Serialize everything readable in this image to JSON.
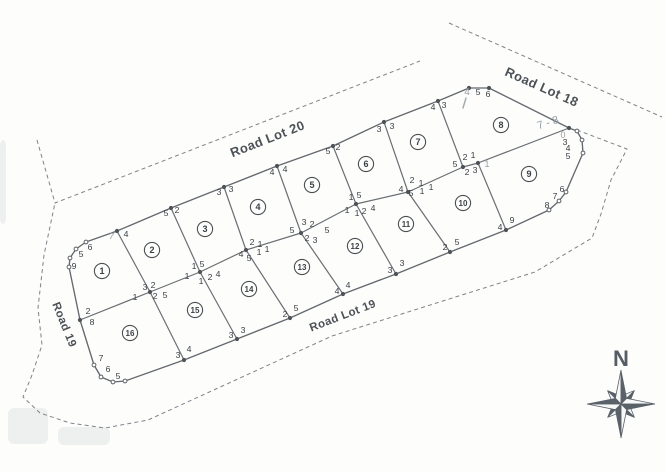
{
  "map": {
    "ink_color": "#64696e",
    "pencil_color": "#9aa0a8",
    "roads": [
      {
        "id": "road-lot-20",
        "label": "Road Lot 20",
        "x": 269,
        "y": 143,
        "rot": -21.5,
        "size": 13
      },
      {
        "id": "road-lot-18",
        "label": "Road Lot 18",
        "x": 540,
        "y": 91,
        "rot": 24,
        "size": 13
      },
      {
        "id": "road-lot-19",
        "label": "Road Lot 19",
        "x": 344,
        "y": 319,
        "rot": -21,
        "size": 11.5
      },
      {
        "id": "road-19",
        "label": "Road 19",
        "x": 61,
        "y": 326,
        "rot": 68,
        "size": 11.5
      }
    ],
    "compass": {
      "label": "N",
      "cx": 621,
      "cy": 404,
      "letter_x": 621,
      "letter_y": 366,
      "r_cardinal": 34,
      "r_diagonal": 19,
      "r_base": 8
    },
    "lots": [
      {
        "n": "1",
        "x": 102,
        "y": 271
      },
      {
        "n": "2",
        "x": 152,
        "y": 250
      },
      {
        "n": "3",
        "x": 205,
        "y": 229
      },
      {
        "n": "4",
        "x": 258,
        "y": 207
      },
      {
        "n": "5",
        "x": 312,
        "y": 185
      },
      {
        "n": "6",
        "x": 366,
        "y": 164
      },
      {
        "n": "7",
        "x": 418,
        "y": 142
      },
      {
        "n": "8",
        "x": 501,
        "y": 125
      },
      {
        "n": "9",
        "x": 529,
        "y": 174
      },
      {
        "n": "10",
        "x": 463,
        "y": 203
      },
      {
        "n": "11",
        "x": 406,
        "y": 224
      },
      {
        "n": "12",
        "x": 355,
        "y": 246
      },
      {
        "n": "13",
        "x": 302,
        "y": 267
      },
      {
        "n": "14",
        "x": 249,
        "y": 289
      },
      {
        "n": "15",
        "x": 195,
        "y": 310
      },
      {
        "n": "16",
        "x": 130,
        "y": 333
      }
    ],
    "outline": [
      [
        86,
        242
      ],
      [
        117,
        231
      ],
      [
        171,
        208
      ],
      [
        224,
        187
      ],
      [
        277,
        166
      ],
      [
        333,
        146
      ],
      [
        384,
        122
      ],
      [
        438,
        101
      ],
      [
        469,
        88
      ],
      [
        489,
        88
      ],
      [
        569,
        128
      ],
      [
        577,
        131
      ],
      [
        582,
        140
      ],
      [
        583,
        153
      ],
      [
        566,
        192
      ],
      [
        559,
        201
      ],
      [
        549,
        210
      ],
      [
        506,
        230
      ],
      [
        450,
        252
      ],
      [
        396,
        274
      ],
      [
        343,
        294
      ],
      [
        290,
        318
      ],
      [
        237,
        339
      ],
      [
        184,
        360
      ],
      [
        125,
        381
      ],
      [
        113,
        382
      ],
      [
        101,
        377
      ],
      [
        94,
        365
      ],
      [
        80,
        320
      ],
      [
        69,
        267
      ],
      [
        70,
        258
      ],
      [
        76,
        249
      ],
      [
        86,
        242
      ]
    ],
    "inner_lines": [
      [
        [
          80,
          320
        ],
        [
          150,
          292
        ],
        [
          200,
          272
        ],
        [
          246,
          250
        ],
        [
          301,
          233
        ],
        [
          356,
          204
        ],
        [
          408,
          192
        ],
        [
          463,
          167
        ],
        [
          478,
          163
        ],
        [
          569,
          128
        ]
      ],
      [
        [
          117,
          231
        ],
        [
          150,
          292
        ],
        [
          184,
          360
        ]
      ],
      [
        [
          171,
          208
        ],
        [
          200,
          272
        ],
        [
          237,
          339
        ]
      ],
      [
        [
          224,
          187
        ],
        [
          246,
          250
        ],
        [
          290,
          318
        ]
      ],
      [
        [
          277,
          166
        ],
        [
          301,
          233
        ],
        [
          343,
          294
        ]
      ],
      [
        [
          333,
          146
        ],
        [
          356,
          204
        ],
        [
          396,
          274
        ]
      ],
      [
        [
          384,
          122
        ],
        [
          408,
          192
        ],
        [
          450,
          252
        ]
      ],
      [
        [
          438,
          101
        ],
        [
          463,
          167
        ]
      ],
      [
        [
          478,
          163
        ],
        [
          506,
          230
        ]
      ]
    ],
    "dashed_lines": [
      [
        [
          37,
          140
        ],
        [
          55,
          203
        ],
        [
          420,
          61
        ]
      ],
      [
        [
          449,
          23
        ],
        [
          560,
          72
        ],
        [
          662,
          117
        ]
      ],
      [
        [
          577,
          130
        ],
        [
          627,
          149
        ],
        [
          611,
          180
        ],
        [
          601,
          214
        ],
        [
          592,
          238
        ],
        [
          535,
          272
        ],
        [
          465,
          294
        ],
        [
          332,
          336
        ],
        [
          148,
          420
        ],
        [
          105,
          428
        ],
        [
          70,
          423
        ],
        [
          40,
          413
        ],
        [
          23,
          397
        ],
        [
          32,
          375
        ],
        [
          42,
          345
        ],
        [
          38,
          308
        ],
        [
          44,
          255
        ],
        [
          55,
          203
        ]
      ]
    ],
    "junction_dots": [
      [
        117,
        231
      ],
      [
        171,
        208
      ],
      [
        224,
        187
      ],
      [
        277,
        166
      ],
      [
        333,
        146
      ],
      [
        384,
        122
      ],
      [
        438,
        101
      ],
      [
        469,
        88
      ],
      [
        489,
        88
      ],
      [
        569,
        128
      ],
      [
        80,
        320
      ],
      [
        150,
        292
      ],
      [
        200,
        272
      ],
      [
        246,
        250
      ],
      [
        301,
        233
      ],
      [
        356,
        204
      ],
      [
        408,
        192
      ],
      [
        463,
        167
      ],
      [
        478,
        163
      ],
      [
        184,
        360
      ],
      [
        237,
        339
      ],
      [
        290,
        318
      ],
      [
        343,
        294
      ],
      [
        396,
        274
      ],
      [
        450,
        252
      ],
      [
        506,
        230
      ]
    ],
    "open_dots": [
      [
        86,
        242
      ],
      [
        76,
        249
      ],
      [
        70,
        258
      ],
      [
        69,
        267
      ],
      [
        94,
        365
      ],
      [
        101,
        377
      ],
      [
        113,
        382
      ],
      [
        125,
        381
      ],
      [
        577,
        131
      ],
      [
        582,
        140
      ],
      [
        583,
        153
      ],
      [
        566,
        192
      ],
      [
        559,
        201
      ],
      [
        549,
        210
      ]
    ],
    "vertex_labels": [
      {
        "t": "4",
        "x": 126,
        "y": 237
      },
      {
        "t": "5",
        "x": 166,
        "y": 216
      },
      {
        "t": "2",
        "x": 177,
        "y": 213
      },
      {
        "t": "3",
        "x": 219,
        "y": 195
      },
      {
        "t": "3",
        "x": 231,
        "y": 192
      },
      {
        "t": "4",
        "x": 272,
        "y": 175
      },
      {
        "t": "4",
        "x": 285,
        "y": 172
      },
      {
        "t": "5",
        "x": 328,
        "y": 154
      },
      {
        "t": "2",
        "x": 338,
        "y": 150
      },
      {
        "t": "3",
        "x": 379,
        "y": 132
      },
      {
        "t": "3",
        "x": 392,
        "y": 129
      },
      {
        "t": "4",
        "x": 433,
        "y": 110
      },
      {
        "t": "3",
        "x": 444,
        "y": 108
      },
      {
        "t": "5",
        "x": 478,
        "y": 95
      },
      {
        "t": "6",
        "x": 488,
        "y": 97
      },
      {
        "t": "6",
        "x": 90,
        "y": 250
      },
      {
        "t": "5",
        "x": 81,
        "y": 257
      },
      {
        "t": "9",
        "x": 74,
        "y": 269
      },
      {
        "t": "2",
        "x": 88,
        "y": 314
      },
      {
        "t": "8",
        "x": 92,
        "y": 325
      },
      {
        "t": "7",
        "x": 101,
        "y": 361
      },
      {
        "t": "6",
        "x": 108,
        "y": 372
      },
      {
        "t": "5",
        "x": 118,
        "y": 379
      },
      {
        "t": "3",
        "x": 145,
        "y": 290
      },
      {
        "t": "2",
        "x": 153,
        "y": 288
      },
      {
        "t": "1",
        "x": 135,
        "y": 300
      },
      {
        "t": "2",
        "x": 155,
        "y": 299
      },
      {
        "t": "5",
        "x": 165,
        "y": 298
      },
      {
        "t": "1",
        "x": 194,
        "y": 269
      },
      {
        "t": "5",
        "x": 202,
        "y": 267
      },
      {
        "t": "1",
        "x": 187,
        "y": 279
      },
      {
        "t": "1",
        "x": 201,
        "y": 284
      },
      {
        "t": "2",
        "x": 210,
        "y": 280
      },
      {
        "t": "4",
        "x": 218,
        "y": 277
      },
      {
        "t": "2",
        "x": 252,
        "y": 245
      },
      {
        "t": "1",
        "x": 260,
        "y": 247
      },
      {
        "t": "4",
        "x": 241,
        "y": 257
      },
      {
        "t": "5",
        "x": 249,
        "y": 261
      },
      {
        "t": "1",
        "x": 259,
        "y": 255
      },
      {
        "t": "1",
        "x": 267,
        "y": 252
      },
      {
        "t": "3",
        "x": 304,
        "y": 225
      },
      {
        "t": "2",
        "x": 312,
        "y": 227
      },
      {
        "t": "5",
        "x": 292,
        "y": 233
      },
      {
        "t": "2",
        "x": 307,
        "y": 241
      },
      {
        "t": "3",
        "x": 315,
        "y": 243
      },
      {
        "t": "5",
        "x": 327,
        "y": 233
      },
      {
        "t": "1",
        "x": 351,
        "y": 200
      },
      {
        "t": "5",
        "x": 359,
        "y": 198
      },
      {
        "t": "1",
        "x": 347,
        "y": 213
      },
      {
        "t": "1",
        "x": 357,
        "y": 216
      },
      {
        "t": "2",
        "x": 364,
        "y": 214
      },
      {
        "t": "4",
        "x": 373,
        "y": 211
      },
      {
        "t": "2",
        "x": 412,
        "y": 183
      },
      {
        "t": "1",
        "x": 421,
        "y": 186
      },
      {
        "t": "4",
        "x": 401,
        "y": 192
      },
      {
        "t": "5",
        "x": 411,
        "y": 196
      },
      {
        "t": "1",
        "x": 422,
        "y": 194
      },
      {
        "t": "1",
        "x": 431,
        "y": 190
      },
      {
        "t": "2",
        "x": 465,
        "y": 160
      },
      {
        "t": "1",
        "x": 473,
        "y": 158
      },
      {
        "t": "5",
        "x": 455,
        "y": 167
      },
      {
        "t": "2",
        "x": 467,
        "y": 175
      },
      {
        "t": "3",
        "x": 475,
        "y": 173
      },
      {
        "t": "3",
        "x": 178,
        "y": 358
      },
      {
        "t": "4",
        "x": 189,
        "y": 352
      },
      {
        "t": "3",
        "x": 231,
        "y": 338
      },
      {
        "t": "3",
        "x": 243,
        "y": 333
      },
      {
        "t": "2",
        "x": 285,
        "y": 317
      },
      {
        "t": "5",
        "x": 296,
        "y": 311
      },
      {
        "t": "4",
        "x": 337,
        "y": 294
      },
      {
        "t": "4",
        "x": 348,
        "y": 288
      },
      {
        "t": "3",
        "x": 390,
        "y": 273
      },
      {
        "t": "3",
        "x": 402,
        "y": 266
      },
      {
        "t": "2",
        "x": 445,
        "y": 250
      },
      {
        "t": "5",
        "x": 457,
        "y": 245
      },
      {
        "t": "4",
        "x": 500,
        "y": 230
      },
      {
        "t": "9",
        "x": 512,
        "y": 223
      },
      {
        "t": "3",
        "x": 565,
        "y": 145
      },
      {
        "t": "4",
        "x": 568,
        "y": 151
      },
      {
        "t": "5",
        "x": 568,
        "y": 159
      },
      {
        "t": "6",
        "x": 562,
        "y": 192
      },
      {
        "t": "7",
        "x": 555,
        "y": 199
      },
      {
        "t": "8",
        "x": 547,
        "y": 208
      }
    ],
    "pencil_labels": [
      {
        "t": "7 - 8",
        "x": 549,
        "y": 126,
        "rot": -18,
        "size": 11
      },
      {
        "t": "4",
        "x": 467,
        "y": 95,
        "rot": 0,
        "size": 10
      },
      {
        "t": "0",
        "x": 563,
        "y": 138,
        "rot": 0,
        "size": 9
      },
      {
        "t": "1",
        "x": 487,
        "y": 167,
        "rot": 0,
        "size": 9
      },
      {
        "t": "7",
        "x": 111,
        "y": 239,
        "rot": 12,
        "size": 9
      }
    ],
    "pencil_strokes": [
      [
        [
          466,
          98
        ],
        [
          463,
          108
        ]
      ]
    ],
    "smudges": [
      {
        "x": 8,
        "y": 408,
        "w": 40,
        "h": 36
      },
      {
        "x": 58,
        "y": 427,
        "w": 52,
        "h": 18
      },
      {
        "x": 0,
        "y": 140,
        "w": 6,
        "h": 84
      }
    ]
  }
}
